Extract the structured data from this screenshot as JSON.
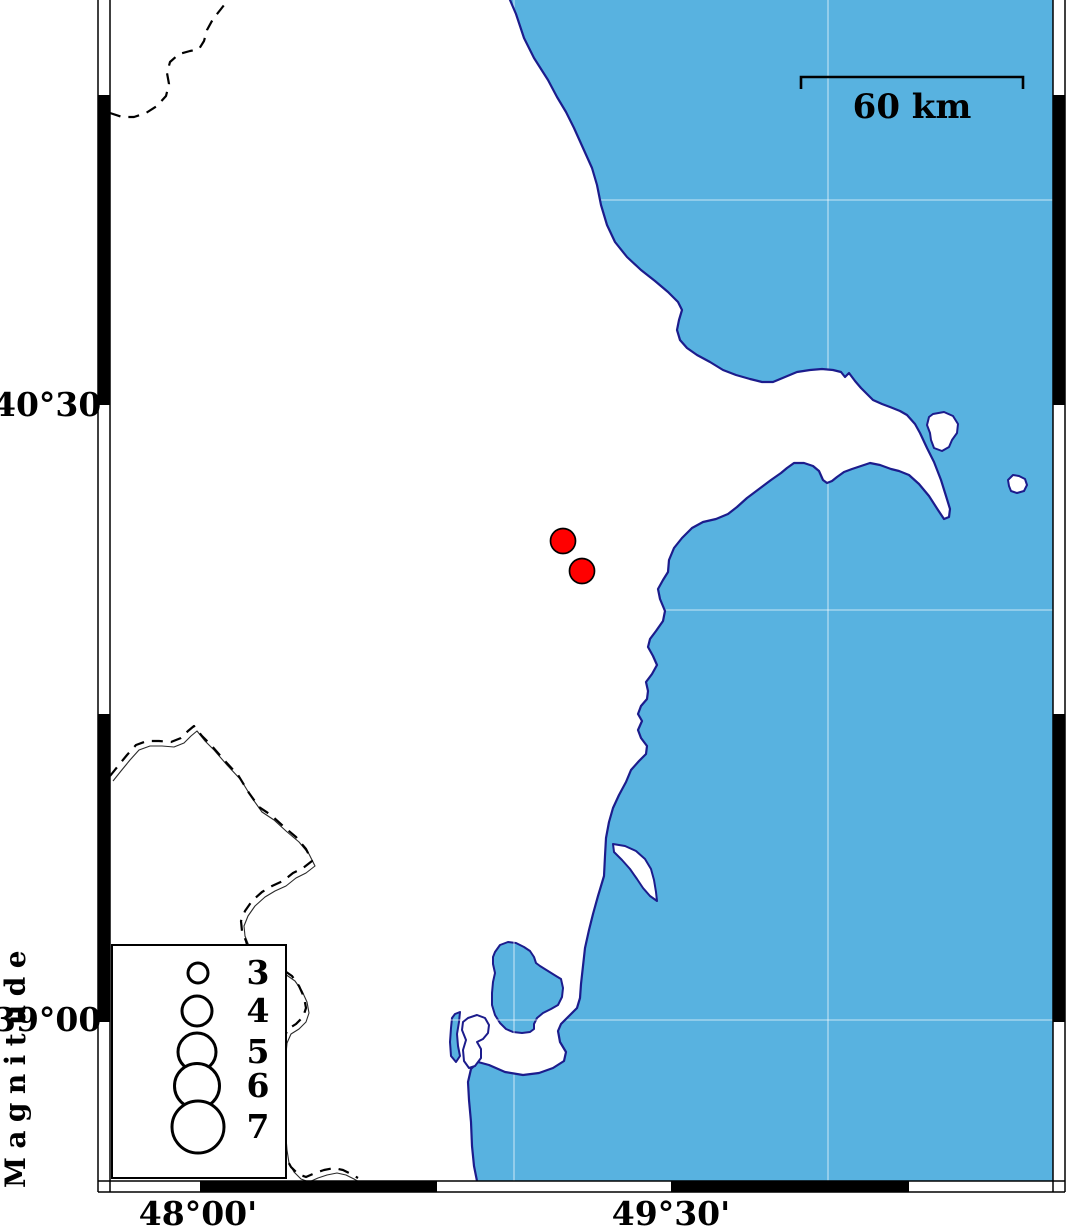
{
  "frame": {
    "lat_labels": [
      {
        "text": "40°30'",
        "y_px": 405
      },
      {
        "text": "39°00'",
        "y_px": 1020
      }
    ],
    "lon_labels": [
      {
        "text": "48°00'",
        "x_px": 198
      },
      {
        "text": "49°30'",
        "x_px": 671
      }
    ]
  },
  "scale_bar": {
    "label": "60 km",
    "km": 60,
    "length_px": 222
  },
  "legend": {
    "title": "Magnitude",
    "entries": [
      {
        "label": "3",
        "radius_px": 10
      },
      {
        "label": "4",
        "radius_px": 15
      },
      {
        "label": "5",
        "radius_px": 19
      },
      {
        "label": "6",
        "radius_px": 22.5
      },
      {
        "label": "7",
        "radius_px": 26
      }
    ]
  },
  "epicenters": [
    {
      "x": 563,
      "y": 541,
      "radius_px": 12.5,
      "lon_est": "49°09'",
      "lat_est": "40°10'",
      "magnitude_est": 4
    },
    {
      "x": 582,
      "y": 571,
      "radius_px": 12.5,
      "lon_est": "49°13'",
      "lat_est": "40°06'",
      "magnitude_est": 4
    }
  ],
  "colors": {
    "sea": "#58B2E0",
    "land": "#FFFFFF",
    "coastline": "#1C1C8C",
    "epicenter": "#FF0000",
    "frame": "#000000"
  }
}
